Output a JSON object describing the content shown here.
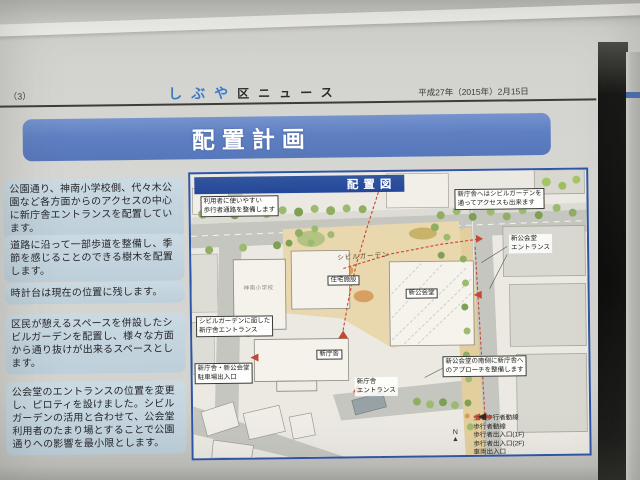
{
  "header": {
    "page_number": "（3）",
    "masthead_kana": [
      "し",
      "ぶ",
      "や"
    ],
    "masthead_rest": "区ニュース",
    "date": "平成27年（2015年）2月15日"
  },
  "banner": {
    "title": "配置計画"
  },
  "notes": [
    "公園通り、神南小学校側、代々木公園など各方面からのアクセスの中心に新庁舎エントランスを配置しています。",
    "道路に沿って一部歩道を整備し、季節を感じることのできる樹木を配置します。",
    "時計台は現在の位置に残します。",
    "区民が憩えるスペースを併設したシビルガーデンを配置し、様々な方面から通り抜けが出来るスペースとします。",
    "公会堂のエントランスの位置を変更し、ピロティを設けました。シビルガーデンの活用と合わせて、公会堂利用者のたまり場とすることで公園通りへの影響を最小限とします。"
  ],
  "map": {
    "title": "配置図",
    "annotations": {
      "walkway": "利用者に使いやすい\n歩行者通路を整備します",
      "garden_access": "新庁舎へはシビルガーデンを\n通ってアクセスも出来ます",
      "hall_entrance": "新公会堂\nエントランス",
      "garden_front_entrance": "シビルガーデンに面した\n新庁舎エントランス",
      "parking": "新庁舎・新公会堂\n駐車場出入口",
      "office_entrance": "新庁舎\nエントランス",
      "south_approach": "新公会堂の南側に新庁舎へ\nのアプローチを整備します"
    },
    "labels": {
      "civil_garden": "シビルガーデン",
      "school": "神南小学校",
      "housing": "住宅施設",
      "new_hall": "新公会堂",
      "new_office": "新庁舎"
    },
    "legend": {
      "items": [
        {
          "label": "主な歩行者動線"
        },
        {
          "label": "歩行者動線"
        },
        {
          "label": "歩行者出入口(1F)"
        },
        {
          "label": "歩行者出入口(2F)"
        },
        {
          "label": "車両出入口"
        }
      ]
    },
    "compass_label": "N"
  },
  "colors": {
    "banner_blue": "#5e7fc2",
    "map_title_blue": "#24479a",
    "note_box_blue": "#c3d4de",
    "flow_red": "#c64832",
    "masthead_blue": "#3f78c2"
  }
}
